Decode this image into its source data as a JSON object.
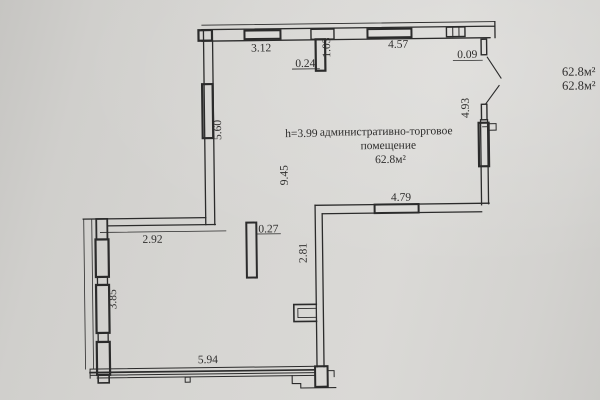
{
  "plan": {
    "height_note": "h=3.99",
    "room_name_line1": "административно-торговое",
    "room_name_line2": "помещение",
    "room_area": "62.8м²",
    "side_area_line1": "62.8м²",
    "side_area_line2": "62.8м²"
  },
  "dims": {
    "top_window_span": "3.12",
    "pier_width": "0.24",
    "pier_length": "1.03",
    "top_right_span": "4.57",
    "top_corner_gap": "0.09",
    "left_upper_wall": "5.60",
    "room_depth": "9.45",
    "step_wall": "2.92",
    "left_lower_wall": "3.85",
    "column_width": "0.27",
    "bottom_wall": "5.94",
    "right_lower_wall": "2.81",
    "mid_wall": "4.79",
    "right_upper_wall": "4.93"
  },
  "colors": {
    "paper": "#d6d5d2",
    "ink": "#2b2b2b"
  }
}
